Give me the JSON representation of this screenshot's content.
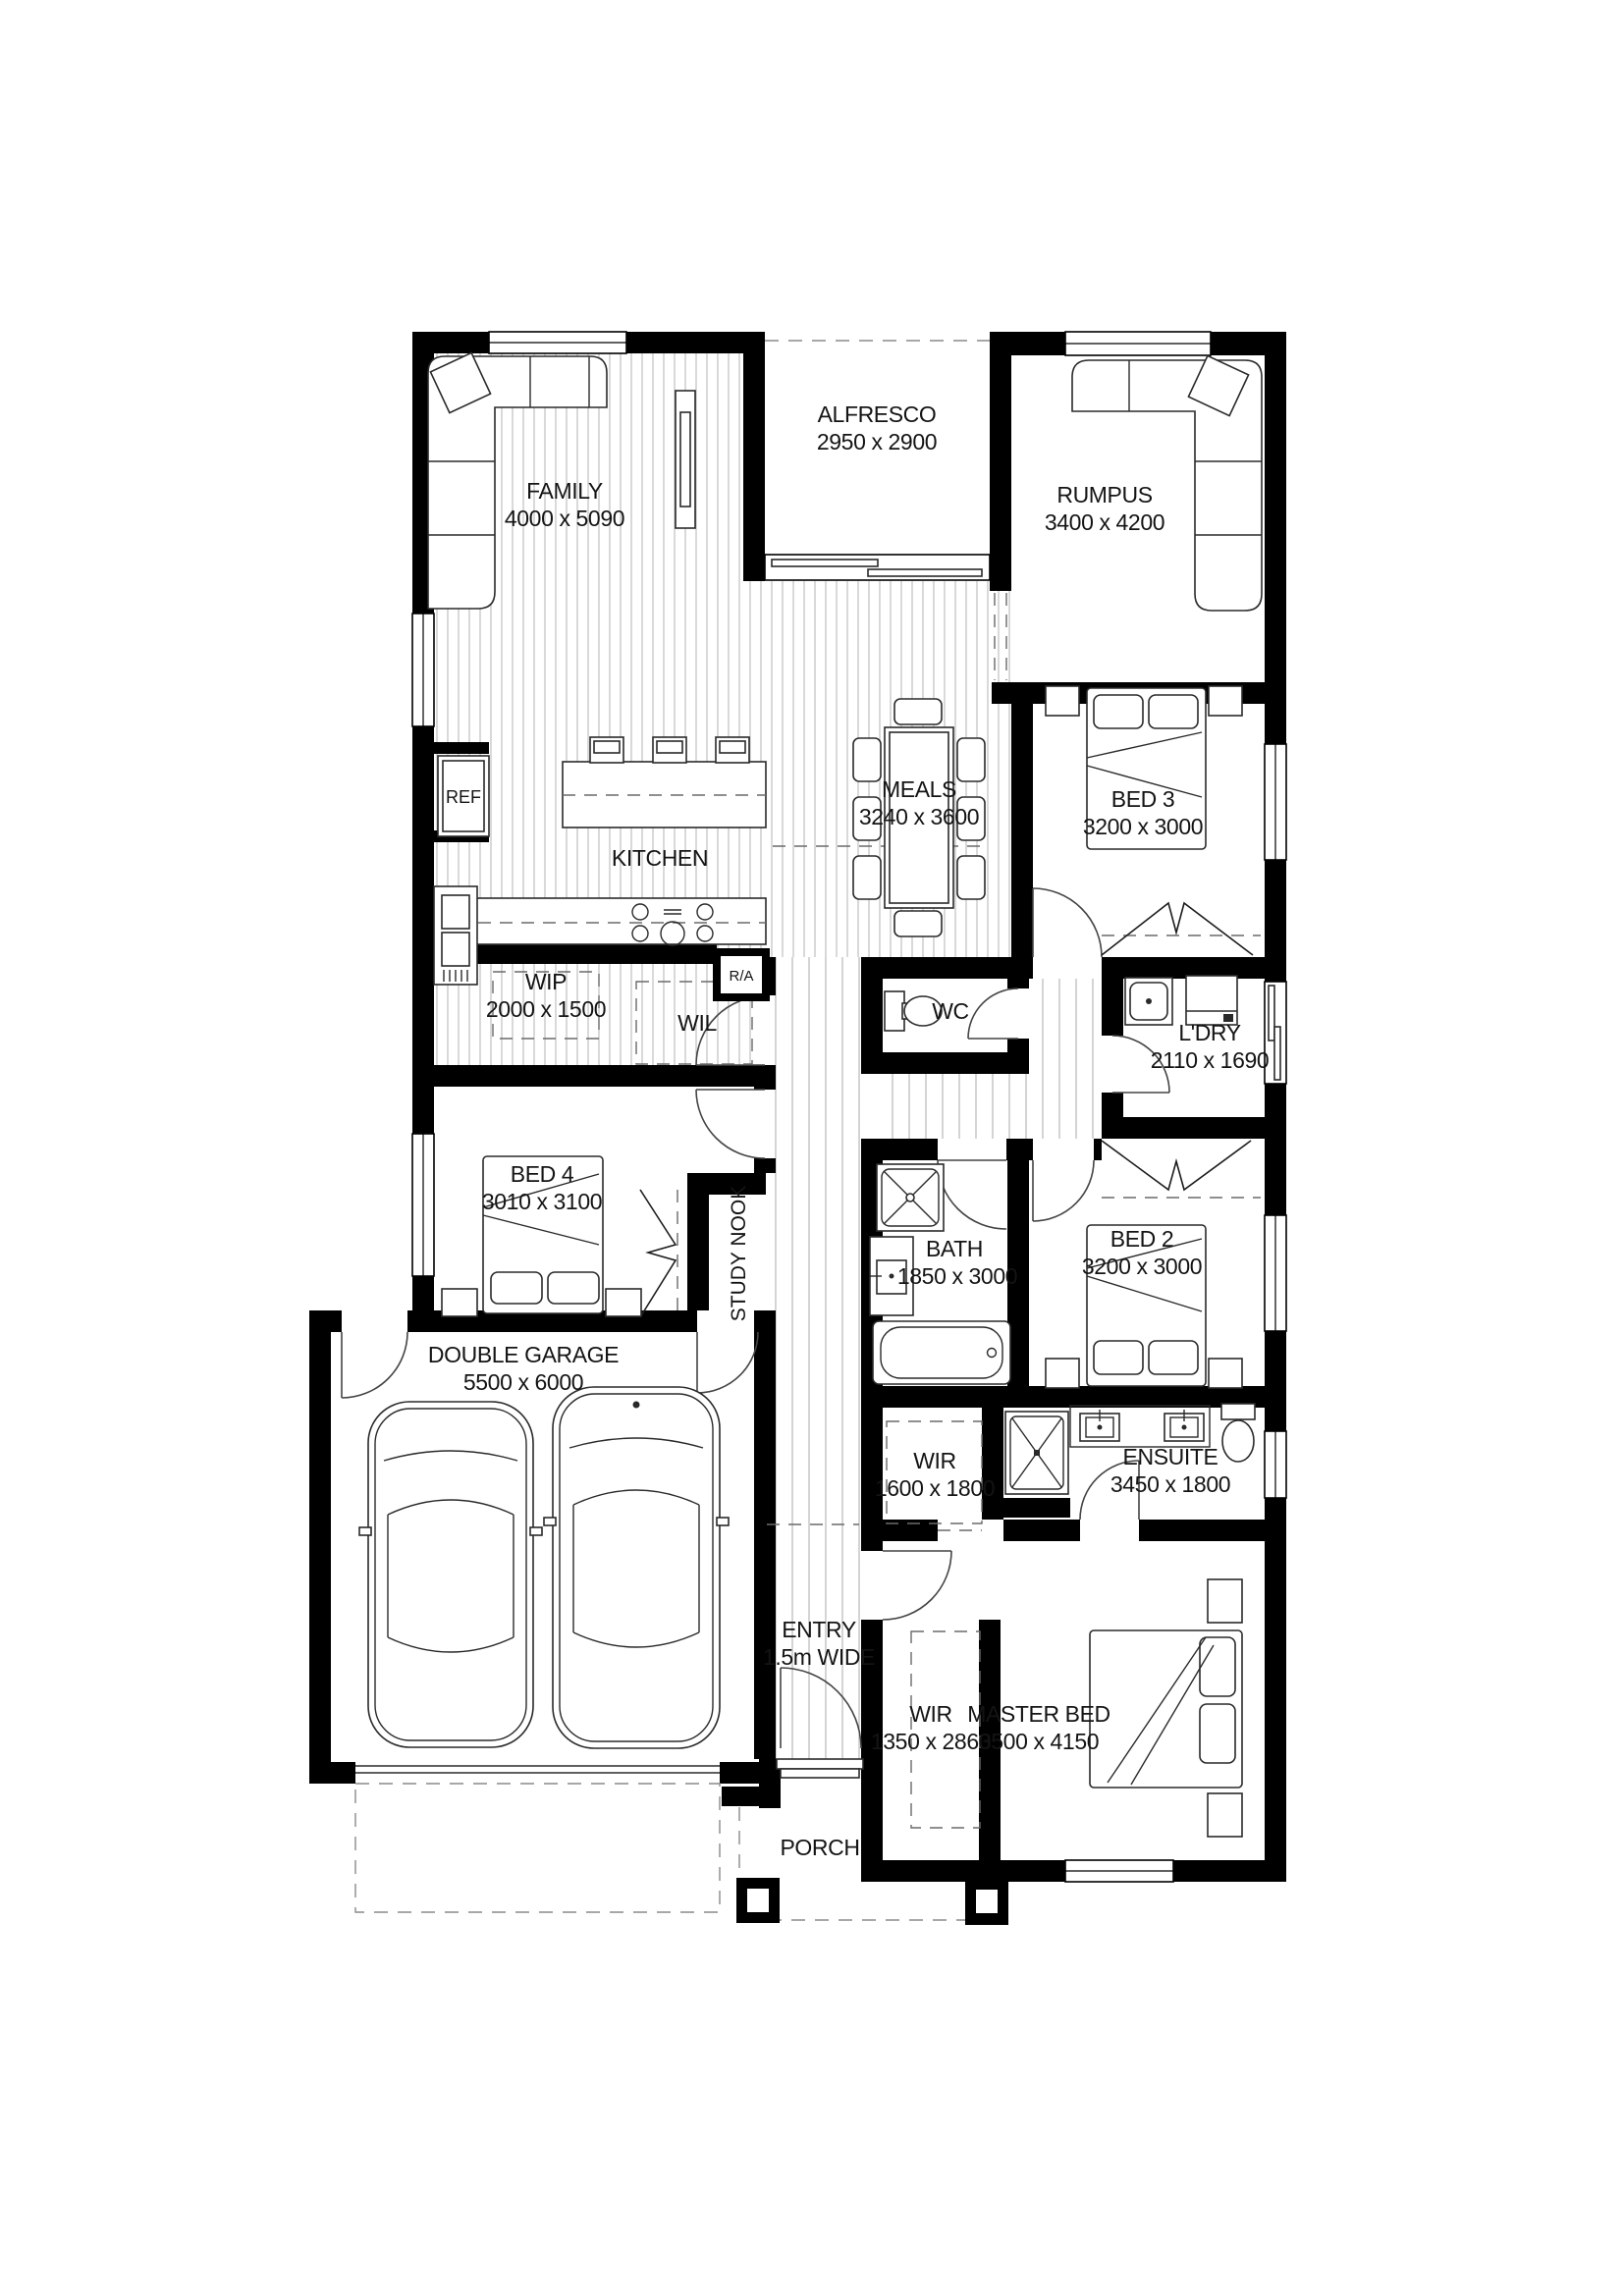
{
  "document": {
    "type": "architectural-floor-plan"
  },
  "rooms": {
    "family": {
      "label": "FAMILY",
      "dims": "4000 x 5090"
    },
    "alfresco": {
      "label": "ALFRESCO",
      "dims": "2950 x 2900"
    },
    "rumpus": {
      "label": "RUMPUS",
      "dims": "3400 x 4200"
    },
    "meals": {
      "label": "MEALS",
      "dims": "3240 x 3600"
    },
    "kitchen": {
      "label": "KITCHEN"
    },
    "bed3": {
      "label": "BED 3",
      "dims": "3200 x 3000"
    },
    "ref": {
      "label": "REF"
    },
    "wip": {
      "label": "WIP",
      "dims": "2000 x 1500"
    },
    "wil": {
      "label": "WIL"
    },
    "ra": {
      "label": "R/A"
    },
    "wc": {
      "label": "WC"
    },
    "ldry": {
      "label": "L'DRY",
      "dims": "2110 x 1690"
    },
    "bed4": {
      "label": "BED 4",
      "dims": "3010 x 3100"
    },
    "study_nook": {
      "label": "STUDY NOOK"
    },
    "bath": {
      "label": "BATH",
      "dims": "1850 x 3000"
    },
    "bed2": {
      "label": "BED 2",
      "dims": "3200 x 3000"
    },
    "garage": {
      "label": "DOUBLE GARAGE",
      "dims": "5500 x 6000"
    },
    "wir_minor": {
      "label": "WIR",
      "dims": "1600 x 1800"
    },
    "ensuite": {
      "label": "ENSUITE",
      "dims": "3450 x 1800"
    },
    "entry": {
      "label": "ENTRY",
      "dims": "1.5m WIDE"
    },
    "wir_master": {
      "label": "WIR",
      "dims": "1350 x 2860"
    },
    "master": {
      "label": "MASTER BED",
      "dims": "3500 x 4150"
    },
    "porch": {
      "label": "PORCH"
    }
  },
  "colors": {
    "wall": "#000000",
    "floor_hatch": "#b3b3b3",
    "background": "#ffffff"
  }
}
